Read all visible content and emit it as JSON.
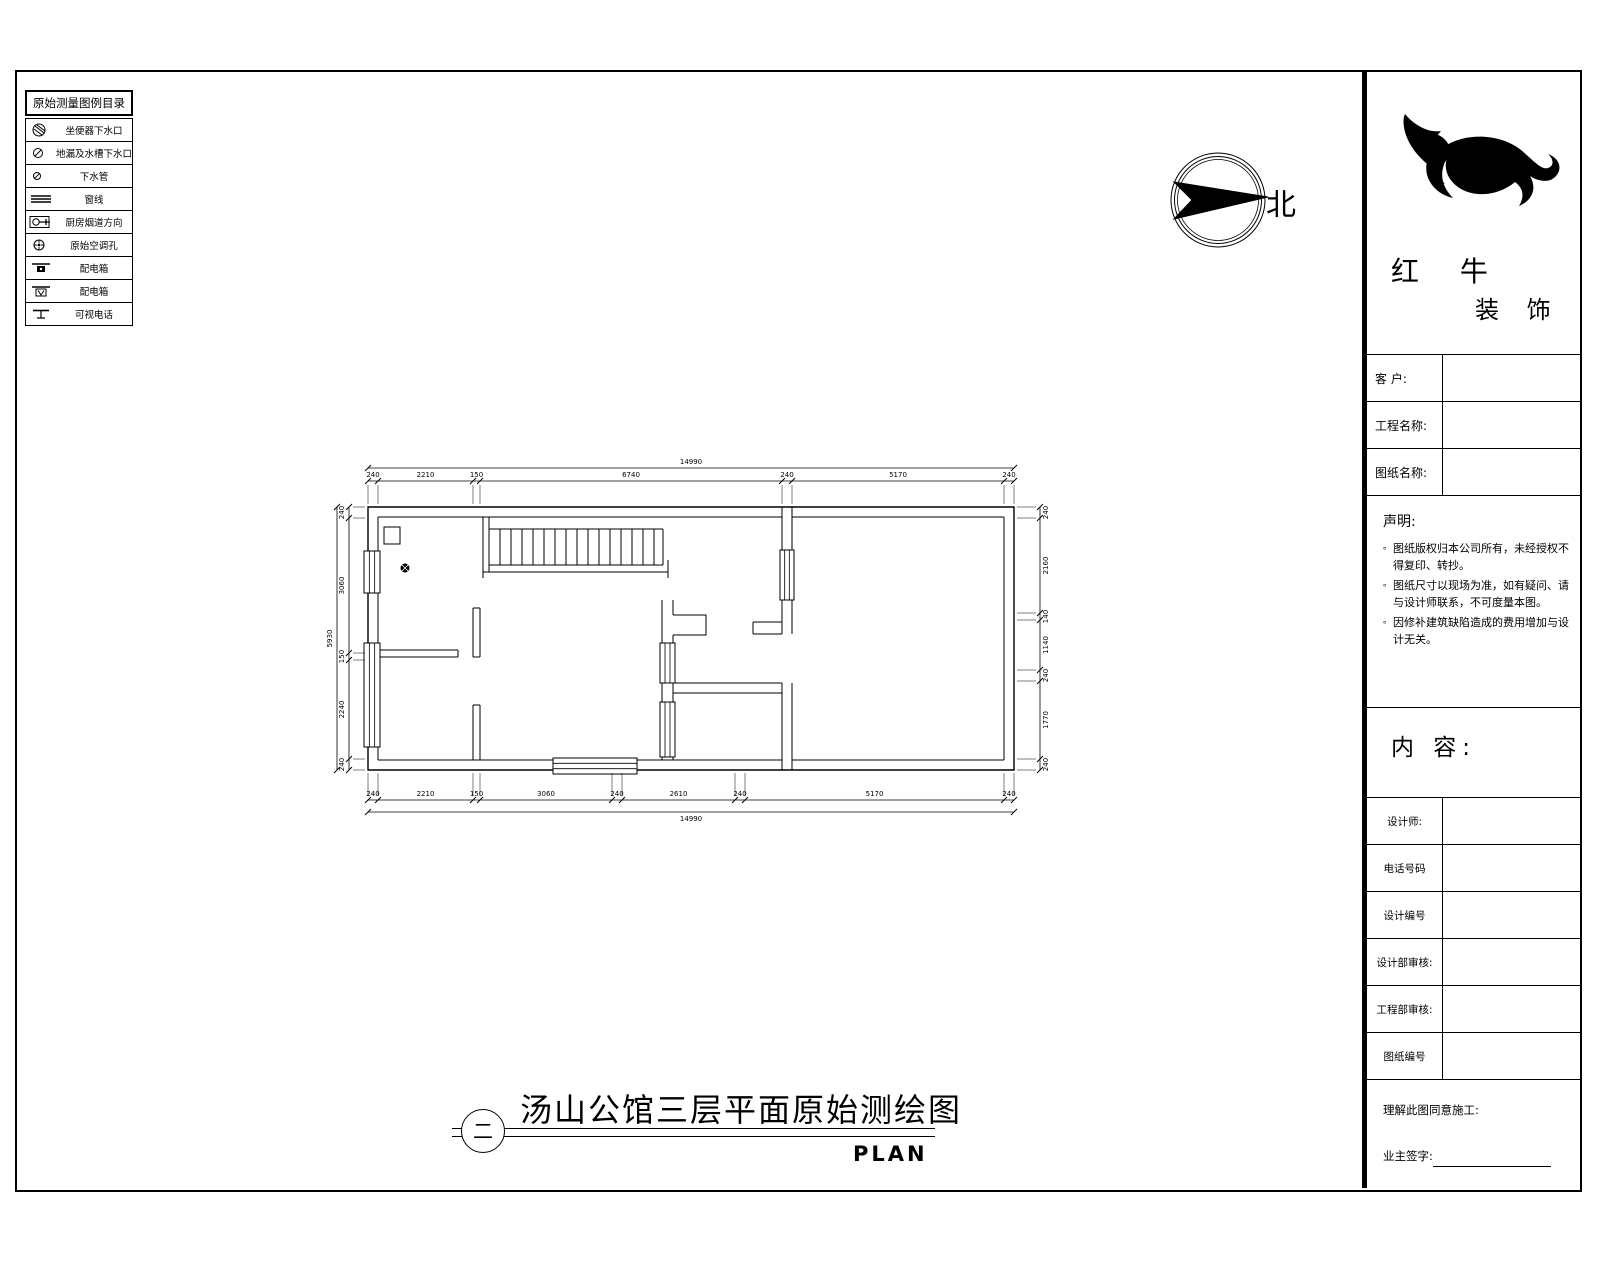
{
  "legend": {
    "title": "原始测量图例目录",
    "items": [
      {
        "icon": "toilet-drain-icon",
        "label": "坐便器下水口"
      },
      {
        "icon": "floor-sink-drain-icon",
        "label": "地漏及水槽下水口"
      },
      {
        "icon": "drain-pipe-icon",
        "label": "下水管"
      },
      {
        "icon": "window-line-icon",
        "label": "窗线"
      },
      {
        "icon": "kitchen-flue-icon",
        "label": "厨房烟道方向"
      },
      {
        "icon": "ac-hole-icon",
        "label": "原始空调孔"
      },
      {
        "icon": "power-box-icon",
        "label": "配电箱"
      },
      {
        "icon": "power-box-2-icon",
        "label": "配电箱"
      },
      {
        "icon": "video-phone-icon",
        "label": "可视电话"
      }
    ]
  },
  "compass": {
    "label": "北"
  },
  "title_block": {
    "brand": {
      "line1": "红 牛",
      "line2": "装 饰"
    },
    "fields": [
      {
        "label": "客 户:",
        "value": ""
      },
      {
        "label": "工程名称:",
        "value": ""
      },
      {
        "label": "图纸名称:",
        "value": ""
      }
    ],
    "statement": {
      "title": "声明:",
      "bullet": "。",
      "items": [
        "图纸版权归本公司所有，未经授权不得复印、转抄。",
        "图纸尺寸以现场为准，如有疑问、请与设计师联系，不可度量本图。",
        "因修补建筑缺陷造成的费用增加与设计无关。"
      ]
    },
    "content_label": "内 容:",
    "rows": [
      {
        "label": "设计师:",
        "value": ""
      },
      {
        "label": "电话号码",
        "value": ""
      },
      {
        "label": "设计编号",
        "value": ""
      },
      {
        "label": "设计部审核:",
        "value": ""
      },
      {
        "label": "工程部审核:",
        "value": ""
      },
      {
        "label": "图纸编号",
        "value": ""
      }
    ],
    "footer": {
      "approval": "理解此图同意施工:",
      "signature": "业主签字:"
    }
  },
  "drawing_title": {
    "text": "汤山公馆三层平面原始测绘图",
    "index": "二",
    "plan_label": "PLAN"
  },
  "plan": {
    "dimensions": {
      "top": {
        "overall": "14990",
        "segments": [
          "240",
          "2210",
          "150",
          "6740",
          "240",
          "5170",
          "240"
        ]
      },
      "bottom": {
        "overall": "14990",
        "segments": [
          "240",
          "2210",
          "150",
          "3060",
          "240",
          "2610",
          "240",
          "5170",
          "240"
        ]
      },
      "left": {
        "overall": "5930",
        "segments": [
          "240",
          "3060",
          "150",
          "2240",
          "240"
        ]
      },
      "right": {
        "segments": [
          "240",
          "2160",
          "140",
          "1140",
          "240",
          "1770",
          "240"
        ]
      }
    }
  }
}
